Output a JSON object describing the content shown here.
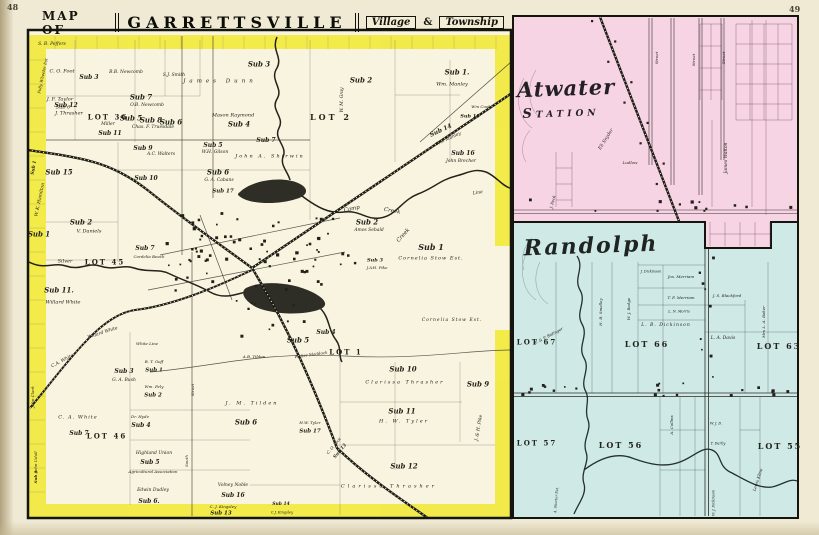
{
  "page": {
    "left_number": "48",
    "right_number": "49"
  },
  "banner": {
    "map_of": "MAP OF",
    "title": "GARRETTSVILLE",
    "village": "Village",
    "amp": "&",
    "township": "Township"
  },
  "insets": {
    "atwater": {
      "title_top": "Atwater",
      "title_bottom": "Station"
    },
    "randolph": {
      "title": "Randolph"
    }
  },
  "colors": {
    "township_border_yellow": "#f2ea3a",
    "atwater_pink": "#f7d4e3",
    "randolph_blue": "#cfe9e7",
    "paper": "#f0ead5",
    "map_cream": "#f9f4e0",
    "ink": "#1d1d15"
  },
  "labels": {
    "main": [
      {
        "t": "S. B. Peffers",
        "x": 52,
        "y": 45,
        "fs": 4.5
      },
      {
        "t": "C. O. Foot",
        "x": 62,
        "y": 72,
        "fs": 5
      },
      {
        "t": "Sub 3",
        "x": 89,
        "y": 78,
        "fs": 6,
        "b": true
      },
      {
        "t": "J. F. Taylor",
        "x": 60,
        "y": 100,
        "fs": 5
      },
      {
        "t": "Sub 6",
        "x": 63,
        "y": 108,
        "fs": 5
      },
      {
        "t": "B.B. Newcomb",
        "x": 126,
        "y": 73,
        "fs": 4.5
      },
      {
        "t": "S.J. Smith",
        "x": 174,
        "y": 76,
        "fs": 4.5
      },
      {
        "t": "Sub 5",
        "x": 131,
        "y": 118,
        "fs": 7,
        "b": true
      },
      {
        "t": "Sub 6",
        "x": 171,
        "y": 122,
        "fs": 7,
        "b": true
      },
      {
        "t": "Sub 12",
        "x": 66,
        "y": 106,
        "fs": 6,
        "b": true
      },
      {
        "t": "J. Thrasher",
        "x": 69,
        "y": 114,
        "fs": 5
      },
      {
        "t": "LOT 36",
        "x": 108,
        "y": 117,
        "fs": 7,
        "b": true,
        "up": true,
        "ls": 2
      },
      {
        "t": "Miller",
        "x": 108,
        "y": 125,
        "fs": 4.5
      },
      {
        "t": "Sub 11",
        "x": 110,
        "y": 134,
        "fs": 6,
        "b": true
      },
      {
        "t": "Sub 7",
        "x": 141,
        "y": 97,
        "fs": 7,
        "b": true
      },
      {
        "t": "O.B. Newcomb",
        "x": 147,
        "y": 106,
        "fs": 4.5
      },
      {
        "t": "Sub 8",
        "x": 151,
        "y": 120,
        "fs": 7,
        "b": true
      },
      {
        "t": "Chas. F. Truesdale",
        "x": 153,
        "y": 128,
        "fs": 4.5
      },
      {
        "t": "Sub 9",
        "x": 143,
        "y": 149,
        "fs": 6,
        "b": true
      },
      {
        "t": "A.C. Walters",
        "x": 161,
        "y": 155,
        "fs": 4.5
      },
      {
        "t": "James Dunn",
        "x": 220,
        "y": 82,
        "fs": 5.5,
        "ls": 4
      },
      {
        "t": "Mason Raymond",
        "x": 233,
        "y": 116,
        "fs": 5
      },
      {
        "t": "Sub 4",
        "x": 239,
        "y": 124,
        "fs": 7,
        "b": true
      },
      {
        "t": "Sub 5",
        "x": 213,
        "y": 146,
        "fs": 6,
        "b": true
      },
      {
        "t": "W.H. Gilson",
        "x": 215,
        "y": 153,
        "fs": 4.5
      },
      {
        "t": "Sub 3",
        "x": 259,
        "y": 64,
        "fs": 7,
        "b": true
      },
      {
        "t": "Sub 2",
        "x": 361,
        "y": 80,
        "fs": 7,
        "b": true
      },
      {
        "t": "Sub 1.",
        "x": 457,
        "y": 72,
        "fs": 7,
        "b": true
      },
      {
        "t": "Wm. Manley",
        "x": 452,
        "y": 85,
        "fs": 5
      },
      {
        "t": "LOT 2",
        "x": 331,
        "y": 117,
        "fs": 8,
        "b": true,
        "up": true,
        "ls": 3
      },
      {
        "t": "W. M. Gray",
        "x": 343,
        "y": 100,
        "fs": 4.5,
        "rot": -90
      },
      {
        "t": "Sub 14",
        "x": 441,
        "y": 131,
        "fs": 6,
        "b": true,
        "rot": -25
      },
      {
        "t": "Wm Manley",
        "x": 449,
        "y": 140,
        "fs": 4.5,
        "rot": -25
      },
      {
        "t": "Wm Cook",
        "x": 481,
        "y": 107,
        "fs": 4
      },
      {
        "t": "Sub 15",
        "x": 470,
        "y": 117,
        "fs": 5,
        "b": true
      },
      {
        "t": "Sub 16",
        "x": 463,
        "y": 154,
        "fs": 6,
        "b": true
      },
      {
        "t": "John Brecher",
        "x": 461,
        "y": 162,
        "fs": 4.5
      },
      {
        "t": "Sub 7",
        "x": 266,
        "y": 141,
        "fs": 6,
        "b": true
      },
      {
        "t": "John A. Shirwin",
        "x": 270,
        "y": 157,
        "fs": 5,
        "ls": 2
      },
      {
        "t": "Sub 6",
        "x": 218,
        "y": 172,
        "fs": 7,
        "b": true
      },
      {
        "t": "G. A. Cabans",
        "x": 219,
        "y": 181,
        "fs": 4.5
      },
      {
        "t": "Sub 17",
        "x": 223,
        "y": 192,
        "fs": 5.5,
        "b": true
      },
      {
        "t": "Sub 10",
        "x": 146,
        "y": 179,
        "fs": 6,
        "b": true
      },
      {
        "t": "Sub 15",
        "x": 59,
        "y": 172,
        "fs": 7,
        "b": true
      },
      {
        "t": "W. K. Hamilton",
        "x": 41,
        "y": 200,
        "fs": 4.5,
        "rot": -78
      },
      {
        "t": "Sub 2",
        "x": 81,
        "y": 222,
        "fs": 7,
        "b": true
      },
      {
        "t": "V. Daniels",
        "x": 89,
        "y": 232,
        "fs": 5
      },
      {
        "t": "Sub 1",
        "x": 39,
        "y": 234,
        "fs": 7,
        "b": true
      },
      {
        "t": "Silver",
        "x": 65,
        "y": 262,
        "fs": 5
      },
      {
        "t": "LOT 45",
        "x": 105,
        "y": 262,
        "fs": 7,
        "b": true,
        "up": true,
        "ls": 2
      },
      {
        "t": "Sub 11.",
        "x": 59,
        "y": 290,
        "fs": 7,
        "b": true
      },
      {
        "t": "Willard White",
        "x": 63,
        "y": 303,
        "fs": 5
      },
      {
        "t": "Sub 7",
        "x": 145,
        "y": 249,
        "fs": 6,
        "b": true
      },
      {
        "t": "Cordelia Beach",
        "x": 149,
        "y": 257,
        "fs": 4
      },
      {
        "t": "Camp",
        "x": 352,
        "y": 210,
        "fs": 5.5,
        "rot": -12
      },
      {
        "t": "Creek",
        "x": 392,
        "y": 212,
        "fs": 5.5,
        "rot": 10
      },
      {
        "t": "Creek",
        "x": 404,
        "y": 236,
        "fs": 5.5,
        "rot": -48
      },
      {
        "t": "Sub 2",
        "x": 367,
        "y": 222,
        "fs": 7,
        "b": true
      },
      {
        "t": "Amos Sebald",
        "x": 369,
        "y": 231,
        "fs": 4.5
      },
      {
        "t": "Sub 1",
        "x": 431,
        "y": 247,
        "fs": 8,
        "b": true
      },
      {
        "t": "Cornelia Stow Est.",
        "x": 431,
        "y": 259,
        "fs": 5,
        "ls": 1
      },
      {
        "t": "Cornelia Stow Est.",
        "x": 452,
        "y": 321,
        "fs": 4.5,
        "ls": 1
      },
      {
        "t": "Line",
        "x": 478,
        "y": 194,
        "fs": 4.5,
        "rot": -8
      },
      {
        "t": "Sub 3",
        "x": 375,
        "y": 261,
        "fs": 5,
        "b": true
      },
      {
        "t": "J.&H. Pike",
        "x": 377,
        "y": 268,
        "fs": 4
      },
      {
        "t": "Sub 5",
        "x": 298,
        "y": 340,
        "fs": 7,
        "b": true
      },
      {
        "t": "Sub 4",
        "x": 326,
        "y": 333,
        "fs": 6,
        "b": true
      },
      {
        "t": "LOT 1",
        "x": 346,
        "y": 352,
        "fs": 7,
        "b": true,
        "up": true,
        "ls": 2
      },
      {
        "t": "Walter Maddock",
        "x": 311,
        "y": 355,
        "fs": 4,
        "rot": -8
      },
      {
        "t": "A.B. Tilden",
        "x": 254,
        "y": 357,
        "fs": 4
      },
      {
        "t": "Sub 10",
        "x": 403,
        "y": 369,
        "fs": 7,
        "b": true
      },
      {
        "t": "Clarissa Thrasher",
        "x": 405,
        "y": 383,
        "fs": 5,
        "ls": 2
      },
      {
        "t": "Sub 9",
        "x": 478,
        "y": 384,
        "fs": 7,
        "b": true
      },
      {
        "t": "Sub 11",
        "x": 402,
        "y": 411,
        "fs": 7,
        "b": true
      },
      {
        "t": "H. W. Tyler",
        "x": 404,
        "y": 422,
        "fs": 5,
        "ls": 2
      },
      {
        "t": "Sub 12",
        "x": 404,
        "y": 466,
        "fs": 7,
        "b": true
      },
      {
        "t": "Clarissa Thrasher",
        "x": 389,
        "y": 487,
        "fs": 5,
        "ls": 3
      },
      {
        "t": "J. & H. Pike",
        "x": 480,
        "y": 428,
        "fs": 4.5,
        "rot": -80
      },
      {
        "t": "Willard White",
        "x": 103,
        "y": 334,
        "fs": 4.5,
        "rot": -18
      },
      {
        "t": "C.A. White",
        "x": 63,
        "y": 362,
        "fs": 4.5,
        "rot": -28
      },
      {
        "t": "White Line",
        "x": 147,
        "y": 344,
        "fs": 4
      },
      {
        "t": "Sub 3",
        "x": 124,
        "y": 372,
        "fs": 6,
        "b": true
      },
      {
        "t": "G. A. Bush",
        "x": 124,
        "y": 381,
        "fs": 4.5
      },
      {
        "t": "B. T. Goff",
        "x": 154,
        "y": 362,
        "fs": 4
      },
      {
        "t": "Sub 1",
        "x": 154,
        "y": 371,
        "fs": 5.5,
        "b": true
      },
      {
        "t": "Wm. Fely",
        "x": 154,
        "y": 387,
        "fs": 4
      },
      {
        "t": "Sub 2",
        "x": 153,
        "y": 396,
        "fs": 5.5,
        "b": true
      },
      {
        "t": "C. A. White",
        "x": 78,
        "y": 418,
        "fs": 5,
        "ls": 1
      },
      {
        "t": "Dr. Hyde",
        "x": 140,
        "y": 417,
        "fs": 4
      },
      {
        "t": "Sub 4",
        "x": 141,
        "y": 426,
        "fs": 6,
        "b": true
      },
      {
        "t": "LOT 46",
        "x": 107,
        "y": 436,
        "fs": 7,
        "b": true,
        "up": true,
        "ls": 2
      },
      {
        "t": "Sub 7",
        "x": 79,
        "y": 434,
        "fs": 6,
        "b": true
      },
      {
        "t": "Highland Union",
        "x": 154,
        "y": 454,
        "fs": 4.5
      },
      {
        "t": "Sub 5",
        "x": 150,
        "y": 463,
        "fs": 6,
        "b": true
      },
      {
        "t": "Agricultural Association",
        "x": 153,
        "y": 472,
        "fs": 4
      },
      {
        "t": "Edwin Dudley",
        "x": 153,
        "y": 491,
        "fs": 4.5
      },
      {
        "t": "Sub 6.",
        "x": 149,
        "y": 502,
        "fs": 6,
        "b": true
      },
      {
        "t": "J. M. Tilden",
        "x": 252,
        "y": 404,
        "fs": 5,
        "ls": 2
      },
      {
        "t": "Sub 6",
        "x": 246,
        "y": 422,
        "fs": 7,
        "b": true
      },
      {
        "t": "Street",
        "x": 193,
        "y": 390,
        "fs": 4,
        "rot": -90
      },
      {
        "t": "South",
        "x": 187,
        "y": 461,
        "fs": 4,
        "rot": -90
      },
      {
        "t": "Volney Noble",
        "x": 233,
        "y": 486,
        "fs": 4.5
      },
      {
        "t": "Sub 16",
        "x": 233,
        "y": 496,
        "fs": 6,
        "b": true
      },
      {
        "t": "C. J. Kingsley",
        "x": 223,
        "y": 507,
        "fs": 4
      },
      {
        "t": "Sub 13",
        "x": 221,
        "y": 514,
        "fs": 5.5,
        "b": true
      },
      {
        "t": "Sub 14",
        "x": 281,
        "y": 505,
        "fs": 4.5,
        "b": true
      },
      {
        "t": "C.J. Kingsley",
        "x": 282,
        "y": 513,
        "fs": 3.5
      },
      {
        "t": "H.W. Tyler",
        "x": 310,
        "y": 423,
        "fs": 4
      },
      {
        "t": "Sub 17",
        "x": 310,
        "y": 432,
        "fs": 5.5,
        "b": true
      },
      {
        "t": "C. O. Foot",
        "x": 334,
        "y": 446,
        "fs": 4,
        "rot": -50
      },
      {
        "t": "Sub 13",
        "x": 341,
        "y": 452,
        "fs": 4.5,
        "b": true,
        "rot": -50
      },
      {
        "t": "John Udall",
        "x": 36,
        "y": 462,
        "fs": 4,
        "rot": -90
      },
      {
        "t": "Sub 8",
        "x": 36,
        "y": 477,
        "fs": 4,
        "b": true,
        "rot": -90
      },
      {
        "t": "John Clark",
        "x": 33,
        "y": 397,
        "fs": 4,
        "rot": -90
      },
      {
        "t": "Polly Wheeler Est",
        "x": 43,
        "y": 76,
        "fs": 4,
        "rot": -78
      },
      {
        "t": "Sub 1",
        "x": 35,
        "y": 168,
        "fs": 4.5,
        "b": true,
        "rot": -80
      }
    ],
    "atwater": [
      {
        "t": "James Walton",
        "x": 727,
        "y": 158,
        "fs": 4.5,
        "rot": -90
      },
      {
        "t": "Eli Snyder",
        "x": 607,
        "y": 140,
        "fs": 4.5,
        "rot": -58
      },
      {
        "t": "J. Peck",
        "x": 553,
        "y": 202,
        "fs": 4,
        "rot": -76
      },
      {
        "t": "Ludlow",
        "x": 630,
        "y": 163,
        "fs": 4
      },
      {
        "t": "Street",
        "x": 657,
        "y": 58,
        "fs": 4,
        "rot": -90
      },
      {
        "t": "Street",
        "x": 694,
        "y": 60,
        "fs": 4,
        "rot": -90
      },
      {
        "t": "Street",
        "x": 724,
        "y": 58,
        "fs": 4,
        "rot": -90
      }
    ],
    "randolph": [
      {
        "t": "LOT 67",
        "x": 537,
        "y": 342,
        "fs": 7,
        "b": true,
        "up": true,
        "ls": 2
      },
      {
        "t": "LOT 66",
        "x": 647,
        "y": 344,
        "fs": 8,
        "b": true,
        "up": true,
        "ls": 2
      },
      {
        "t": "LOT 63",
        "x": 779,
        "y": 346,
        "fs": 8,
        "b": true,
        "up": true,
        "ls": 2
      },
      {
        "t": "LOT 57",
        "x": 537,
        "y": 443,
        "fs": 7,
        "b": true,
        "up": true,
        "ls": 2
      },
      {
        "t": "LOT 56",
        "x": 621,
        "y": 445,
        "fs": 8,
        "b": true,
        "up": true,
        "ls": 2
      },
      {
        "t": "LOT 55",
        "x": 780,
        "y": 446,
        "fs": 8,
        "b": true,
        "up": true,
        "ls": 2
      },
      {
        "t": "J. Dickinson",
        "x": 651,
        "y": 272,
        "fs": 3.5
      },
      {
        "t": "Jos. Merriam",
        "x": 681,
        "y": 277,
        "fs": 4
      },
      {
        "t": "T. F. Merriam",
        "x": 681,
        "y": 298,
        "fs": 4
      },
      {
        "t": "L. N. Morris",
        "x": 679,
        "y": 312,
        "fs": 3.5
      },
      {
        "t": "J. S. Blackford",
        "x": 727,
        "y": 296,
        "fs": 4
      },
      {
        "t": "L. B. Dickinson",
        "x": 666,
        "y": 326,
        "fs": 4.5,
        "ls": 1
      },
      {
        "t": "L. A. Davis",
        "x": 723,
        "y": 339,
        "fs": 4.5
      },
      {
        "t": "Mrs L. A. Baker",
        "x": 764,
        "y": 322,
        "fs": 4,
        "rot": -90
      },
      {
        "t": "H. B. Smalley",
        "x": 601,
        "y": 312,
        "fs": 4,
        "rot": -90
      },
      {
        "t": "W. J. Badge",
        "x": 629,
        "y": 309,
        "fs": 4,
        "rot": -90
      },
      {
        "t": "F. & P. Bidinger",
        "x": 549,
        "y": 336,
        "fs": 4,
        "rot": -28
      },
      {
        "t": "A. Collins",
        "x": 672,
        "y": 425,
        "fs": 4,
        "rot": -90
      },
      {
        "t": "T. Darby",
        "x": 718,
        "y": 444,
        "fs": 3.5
      },
      {
        "t": "W. J. D.",
        "x": 716,
        "y": 424,
        "fs": 3.5
      },
      {
        "t": "Lewis Kline",
        "x": 758,
        "y": 480,
        "fs": 4,
        "rot": -72
      },
      {
        "t": "W. J. Dickinson",
        "x": 714,
        "y": 503,
        "fs": 3.5,
        "rot": -90
      },
      {
        "t": "A. Shorter Est.",
        "x": 557,
        "y": 500,
        "fs": 3.5,
        "rot": -85
      }
    ]
  }
}
